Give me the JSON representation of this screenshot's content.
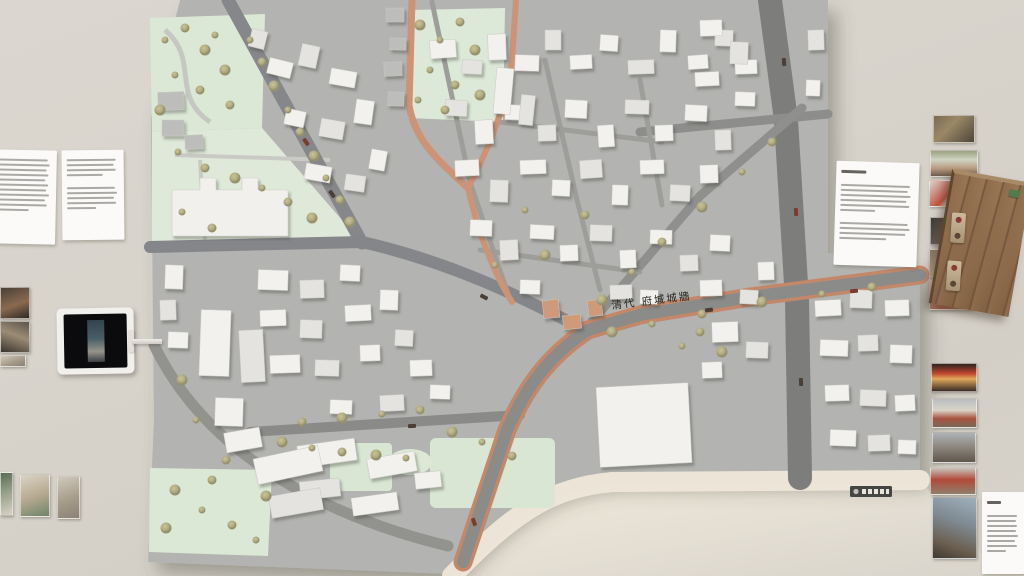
{
  "exhibit": {
    "model_label": "清代 府城城牆",
    "model_plaque": "maker-plaque",
    "colors": {
      "wall": "#d7d3cb",
      "model_base": "#b2b2b0",
      "road": "#7e7f7d",
      "park_green": "#dde8d7",
      "foliage": "#b5b089",
      "historic_route_copper": "#c68a6b",
      "building_white": "#f2f1ee",
      "building_gray": "#c2c2c0",
      "wood_box": "#8d6b4c",
      "plaque_dark": "#454543"
    },
    "left_wall": {
      "text_panels": [
        {
          "name": "left-panel-a",
          "legible": false
        },
        {
          "name": "left-panel-b",
          "legible": false
        }
      ],
      "photo_count": 5,
      "tablet": {
        "state": "playing-dark-video"
      }
    },
    "right_wall": {
      "text_panels": [
        {
          "name": "right-panel",
          "legible": false
        },
        {
          "name": "bottom-right-panel",
          "legible": false
        }
      ],
      "photo_count": 11,
      "wood_model_box": true
    }
  }
}
